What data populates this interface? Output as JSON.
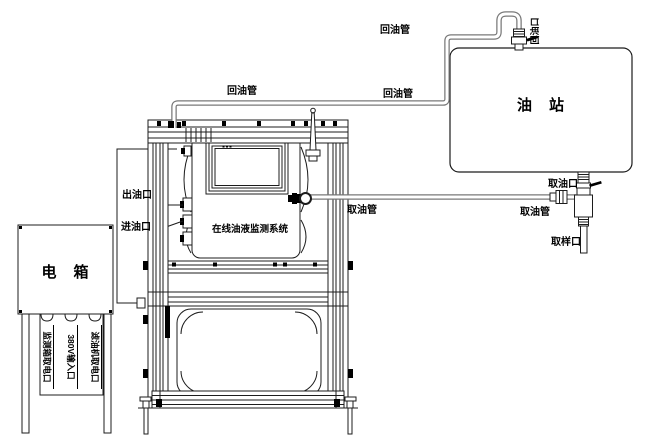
{
  "diagram": {
    "electric_box": {
      "title": "电　箱",
      "power_ports": [
        "监测箱取电口",
        "380V输入口",
        "滤油机取电口"
      ]
    },
    "monitor_cabinet": {
      "system_name": "在线油液监测系统",
      "oil_outlet": "出油口",
      "oil_inlet": "进油口"
    },
    "oil_station": {
      "title": "油　站",
      "return_port": "回油口",
      "take_port": "取油口",
      "sample_port": "取样口"
    },
    "pipes": {
      "return_pipe": "回油管",
      "take_pipe": "取油管"
    },
    "colors": {
      "line": "#1c1c1c",
      "pipe": "#787878",
      "background": "#ffffff"
    }
  }
}
